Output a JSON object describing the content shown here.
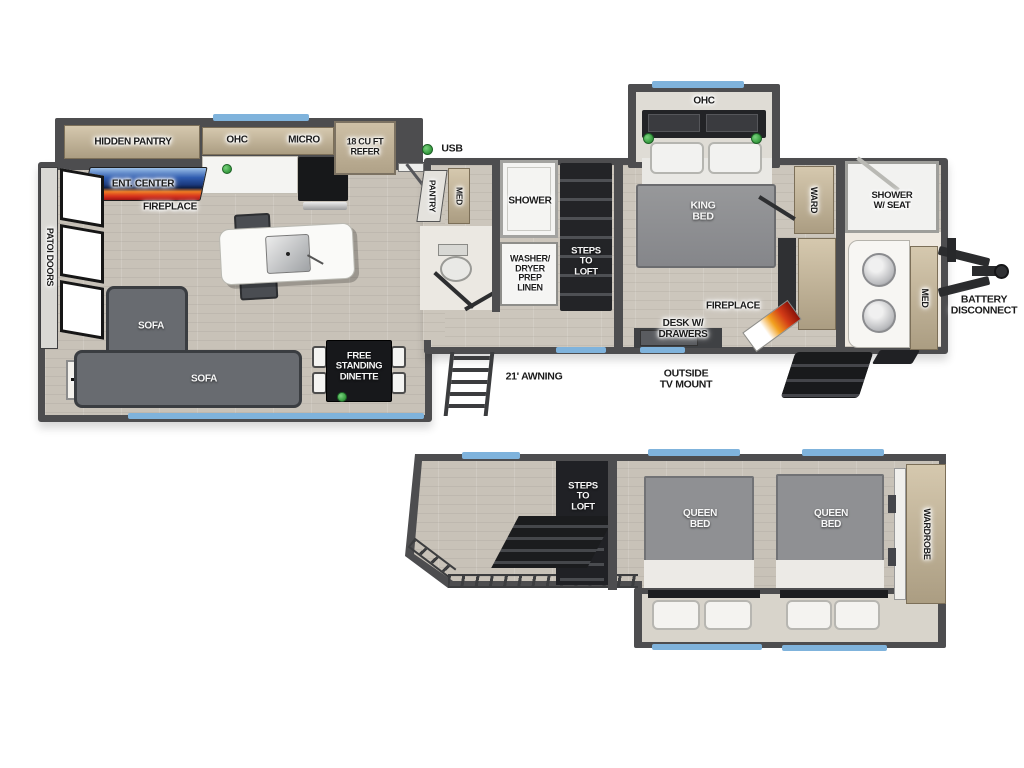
{
  "title": "RV floorplan with loft",
  "colors": {
    "wall": "#4d4d4f",
    "floor_wood": "#c8c2b8",
    "cabinet_tan": "#c0b094",
    "accent_blue": "#7fb3dc",
    "led_green": "#43b04a",
    "tv_blue": "#2f5cb0",
    "flame_orange": "#e8641f",
    "sofa_gray": "#686b70",
    "bed_gray": "#8f9093"
  },
  "main": {
    "hidden_pantry": "HIDDEN PANTRY",
    "ohc_kitchen": "OHC",
    "micro": "MICRO",
    "refer": "18 CU FT\nREFER",
    "usb": "USB",
    "ent_center": "ENT. CENTER",
    "fireplace_rear": "FIREPLACE",
    "patio_doors": "PATOI DOORS",
    "sofa_a": "SOFA",
    "sofa_b": "SOFA",
    "dinette": "FREE\nSTANDING\nDINETTE",
    "pantry": "PANTRY",
    "med_hall": "MED",
    "shower": "SHOWER",
    "washer": "WASHER/\nDRYER\nPREP\nLINEN",
    "steps_to_loft": "STEPS\nTO\nLOFT",
    "ohc_bedroom": "OHC",
    "king_bed": "KING\nBED",
    "ward": "WARD",
    "fireplace_front": "FIREPLACE",
    "desk": "DESK W/\nDRAWERS",
    "shower_w_seat": "SHOWER\nW/ SEAT",
    "med_bath": "MED",
    "awning": "21' AWNING",
    "tv_mount": "OUTSIDE\nTV MOUNT",
    "battery": "BATTERY\nDISCONNECT"
  },
  "loft": {
    "steps_to_loft": "STEPS\nTO\nLOFT",
    "queen_bed_a": "QUEEN\nBED",
    "queen_bed_b": "QUEEN\nBED",
    "wardrobe": "WARDROBE"
  }
}
